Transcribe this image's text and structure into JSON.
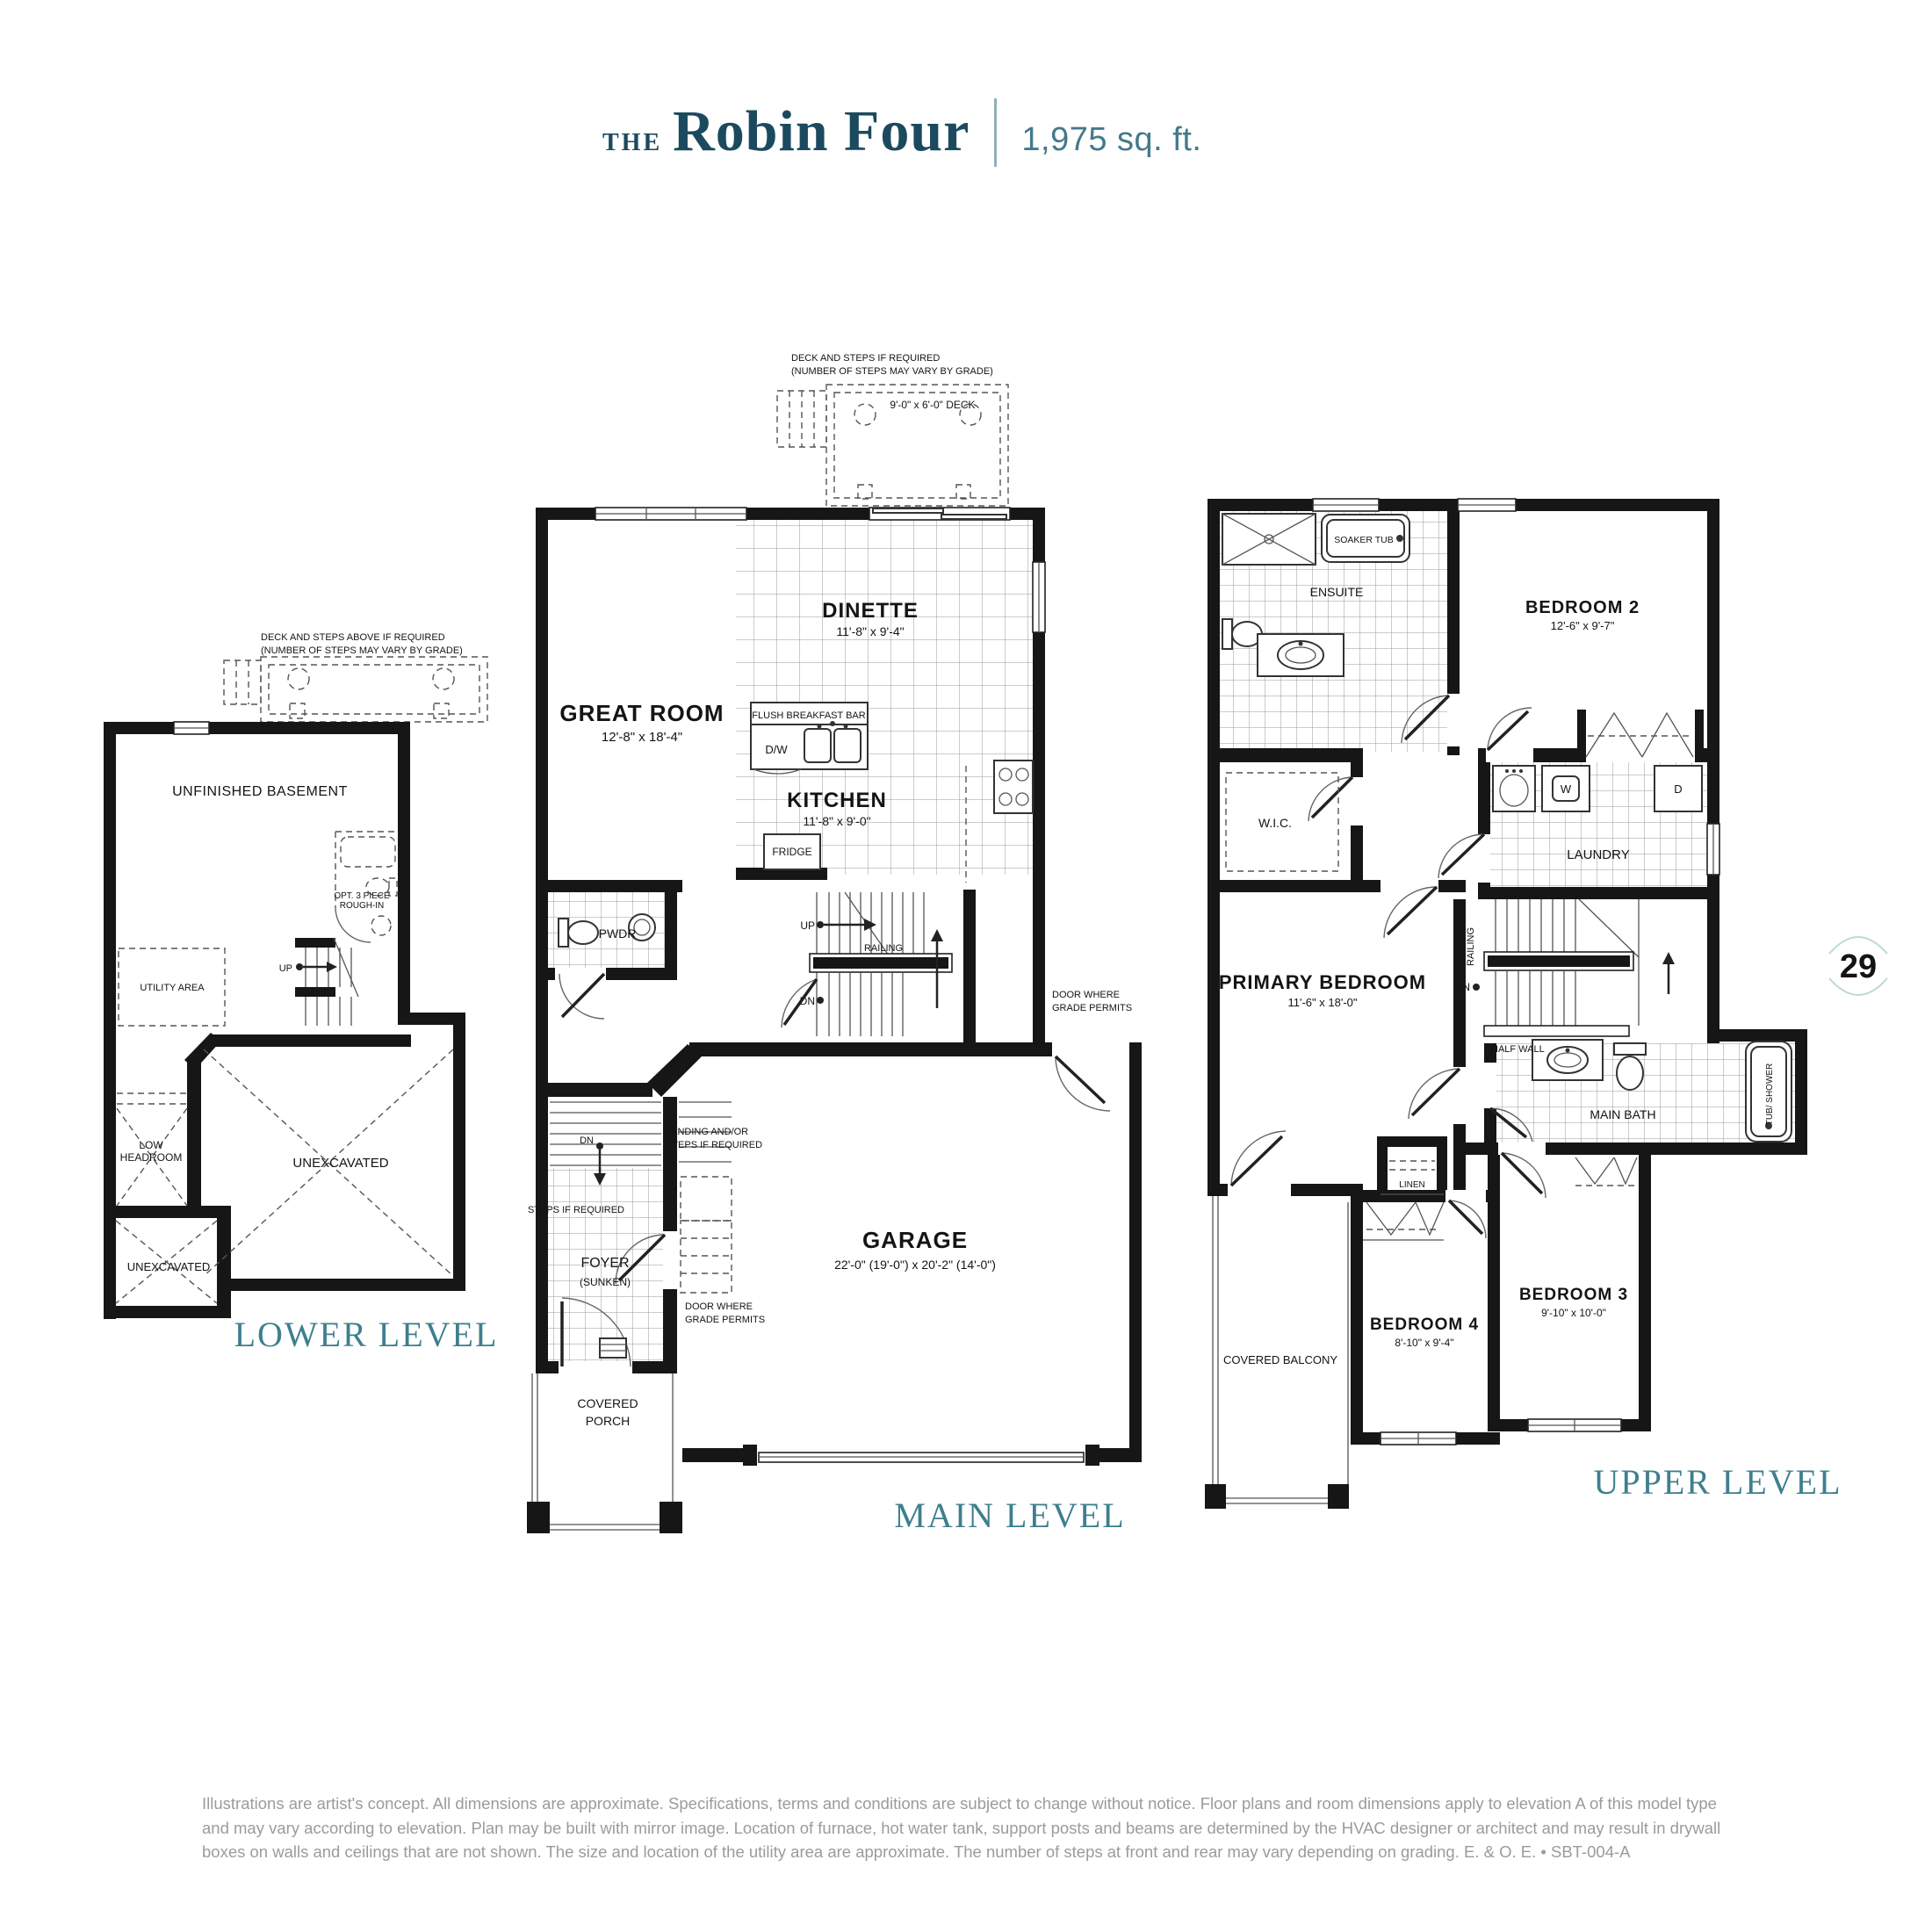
{
  "header": {
    "prefix": "THE",
    "title": "Robin Four",
    "sqft": "1,975 sq. ft."
  },
  "page_number": "29",
  "lower": {
    "label": "LOWER LEVEL",
    "deck_note1": "DECK AND STEPS ABOVE IF REQUIRED",
    "deck_note2": "(NUMBER OF STEPS MAY VARY BY GRADE)",
    "basement": "UNFINISHED BASEMENT",
    "rough_in1": "OPT. 3 PIECE",
    "rough_in2": "ROUGH-IN",
    "utility": "UTILITY AREA",
    "up": "UP",
    "low_headroom1": "LOW",
    "low_headroom2": "HEADROOM",
    "unexcavated": "UNEXCAVATED",
    "unexcavated2": "UNEXCAVATED"
  },
  "main": {
    "label": "MAIN LEVEL",
    "deck_note1": "DECK AND STEPS IF REQUIRED",
    "deck_note2": "(NUMBER OF STEPS MAY VARY BY GRADE)",
    "deck_size": "9'-0\" x 6'-0\" DECK",
    "dinette": "DINETTE",
    "dinette_dim": "11'-8\" x 9'-4\"",
    "great_room": "GREAT ROOM",
    "great_room_dim": "12'-8\" x 18'-4\"",
    "breakfast_bar": "FLUSH BREAKFAST BAR",
    "dw": "D/W",
    "kitchen": "KITCHEN",
    "kitchen_dim": "11'-8\" x 9'-0\"",
    "fridge": "FRIDGE",
    "pwdr": "PWDR",
    "up": "UP",
    "dn": "DN",
    "railing": "RAILING",
    "door_grade1": "DOOR WHERE",
    "door_grade2": "GRADE PERMITS",
    "landing1": "LANDING AND/OR",
    "landing2": "STEPS IF REQUIRED",
    "dn2": "DN",
    "steps_req": "STEPS IF REQUIRED",
    "foyer": "FOYER",
    "sunken": "(SUNKEN)",
    "door_grade3": "DOOR WHERE",
    "door_grade4": "GRADE PERMITS",
    "garage": "GARAGE",
    "garage_dim": "22'-0\" (19'-0\") x 20'-2\" (14'-0\")",
    "porch1": "COVERED",
    "porch2": "PORCH"
  },
  "upper": {
    "label": "UPPER LEVEL",
    "soaker_tub": "SOAKER TUB",
    "ensuite": "ENSUITE",
    "bedroom2": "BEDROOM 2",
    "bedroom2_dim": "12'-6\" x 9'-7\"",
    "wic": "W.I.C.",
    "w": "W",
    "d": "D",
    "laundry": "LAUNDRY",
    "railing": "RAILING",
    "dn": "DN",
    "half_wall": "HALF WALL",
    "primary": "PRIMARY BEDROOM",
    "primary_dim": "11'-6\" x 18'-0\"",
    "main_bath": "MAIN BATH",
    "tub_shower": "TUB/ SHOWER",
    "linen": "LINEN",
    "balcony": "COVERED BALCONY",
    "bedroom4": "BEDROOM 4",
    "bedroom4_dim": "8'-10\" x 9'-4\"",
    "bedroom3": "BEDROOM 3",
    "bedroom3_dim": "9'-10\" x 10'-0\""
  },
  "disclaimer": "Illustrations are artist's concept. All dimensions are approximate. Specifications, terms and conditions are subject to change without notice. Floor plans and room dimensions apply to elevation A of this model type and may vary according to elevation. Plan may be built with mirror image. Location of furnace, hot water tank, support posts and beams are determined by the HVAC designer or architect and may result in drywall boxes on walls and ceilings that are not shown. The size and location of the utility area are approximate. The number of steps at front and rear may vary depending on grading. E. & O. E.  •  SBT-004-A"
}
